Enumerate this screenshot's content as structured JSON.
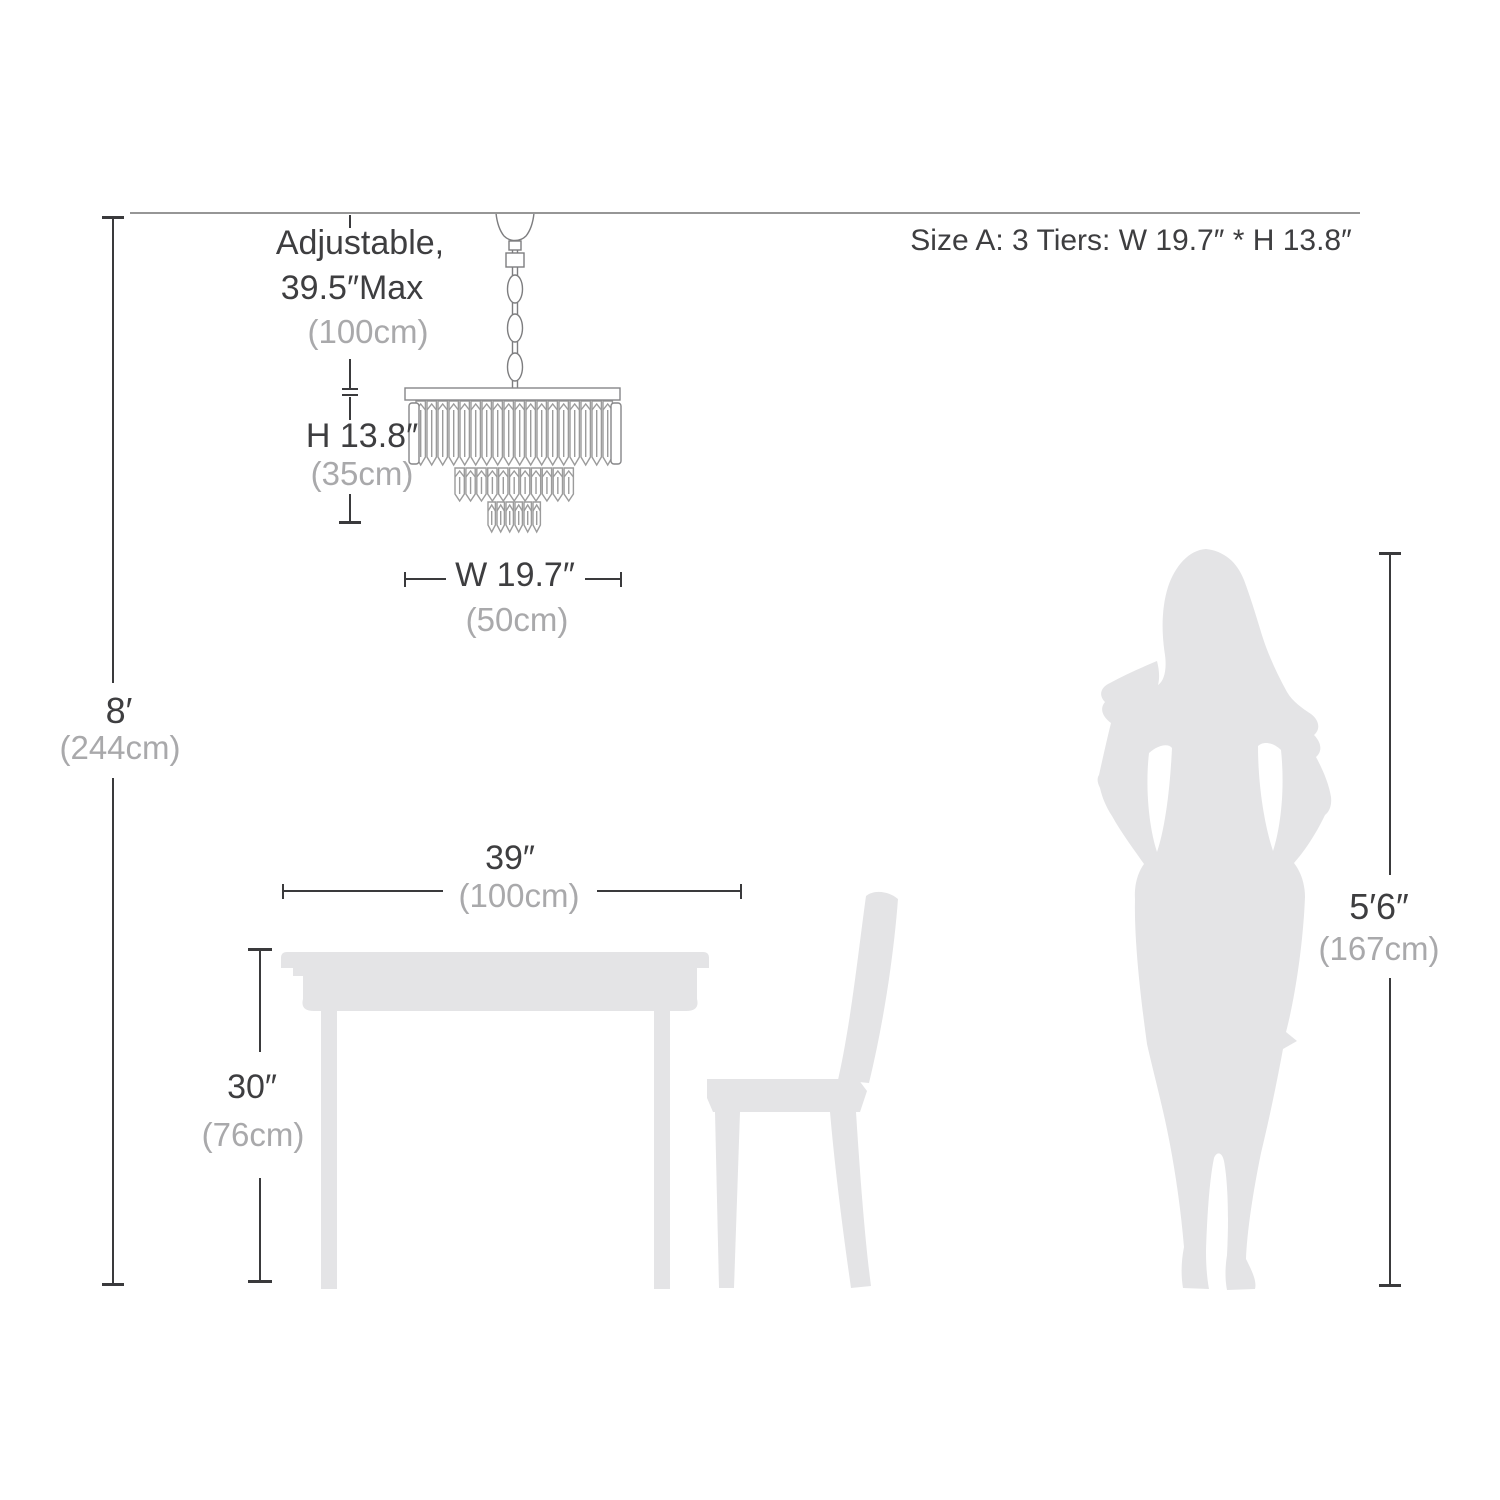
{
  "colors": {
    "background": "#ffffff",
    "silhouette": "#e4e4e6",
    "dark_text": "#3e3e40",
    "muted_text": "#a9a9ab",
    "dimension_line": "#3a3a3c",
    "ceiling_line": "#969696",
    "drawing_outline": "#9b9b9b"
  },
  "header": {
    "size_label": "Size A: 3 Tiers: W 19.7″ * H 13.8″"
  },
  "chandelier": {
    "chain": {
      "label_line1": "Adjustable,",
      "label_line2": "39.5″Max",
      "metric": "(100cm)"
    },
    "height": {
      "label": "H 13.8″",
      "metric": "(35cm)"
    },
    "width": {
      "label": "W 19.7″",
      "metric": "(50cm)"
    }
  },
  "room": {
    "ceiling_height": {
      "label": "8′",
      "metric": "(244cm)"
    }
  },
  "table": {
    "width": {
      "label": "39″",
      "metric": "(100cm)"
    },
    "height": {
      "label": "30″",
      "metric": "(76cm)"
    }
  },
  "person": {
    "height": {
      "label": "5′6″",
      "metric": "(167cm)"
    }
  }
}
